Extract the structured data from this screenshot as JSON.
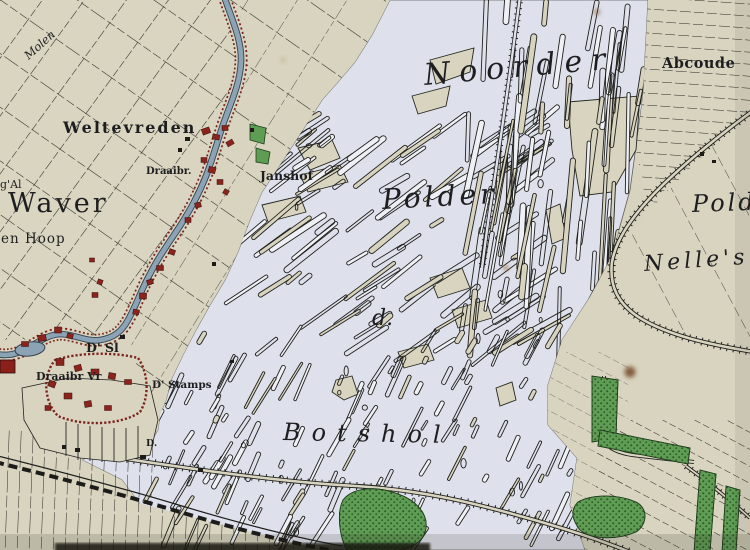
{
  "labels": {
    "noorder": "Noorder",
    "polder": "Polder",
    "de": "d.",
    "botshol": "Botshol",
    "pol_fragment": "Polder",
    "nelles": "Nelle's",
    "abcoude": "Abcoude",
    "weltevreden": "Weltevreden",
    "waver": "Waver",
    "en_hoop": "en Hoop",
    "g_al": "g'Al",
    "molen": "Molen",
    "draaibr": "Draaibr.",
    "janshof": "Janshof",
    "d_sl": "D' Sl",
    "village_draaibr": "Draaibr Vr",
    "stamps": "D' Stamps",
    "d_dot": "D."
  },
  "palette": {
    "paper": "#d7d3bf",
    "water_flat": "#dee1ec",
    "river_blue": "#8ba3b5",
    "road_red": "#7d241e",
    "woods_green": "#5f9c54",
    "ink": "#26261f"
  }
}
